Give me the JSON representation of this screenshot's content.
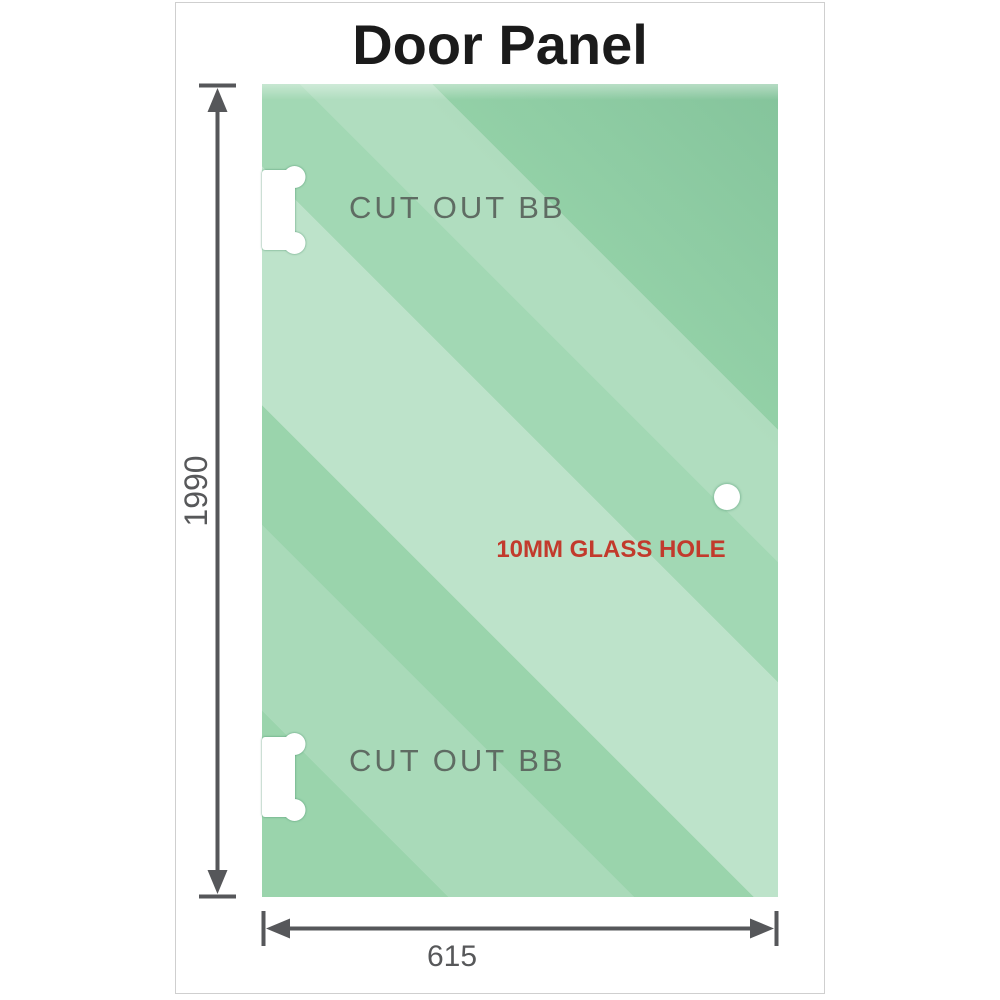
{
  "header": {
    "title": "Door Panel"
  },
  "diagram": {
    "panel": {
      "glass_base_color": "#8ecfa3",
      "glass_highlight_color": "#c2e6cf",
      "glass_dark_color": "#85c99c",
      "cutouts": [
        {
          "label": "CUT OUT BB"
        },
        {
          "label": "CUT OUT BB"
        }
      ],
      "glass_hole": {
        "label": "10MM GLASS HOLE",
        "label_color": "#c23a2c"
      }
    },
    "dimensions": {
      "height": {
        "value": "1990"
      },
      "width": {
        "value": "615"
      },
      "line_color": "#56575a"
    }
  }
}
